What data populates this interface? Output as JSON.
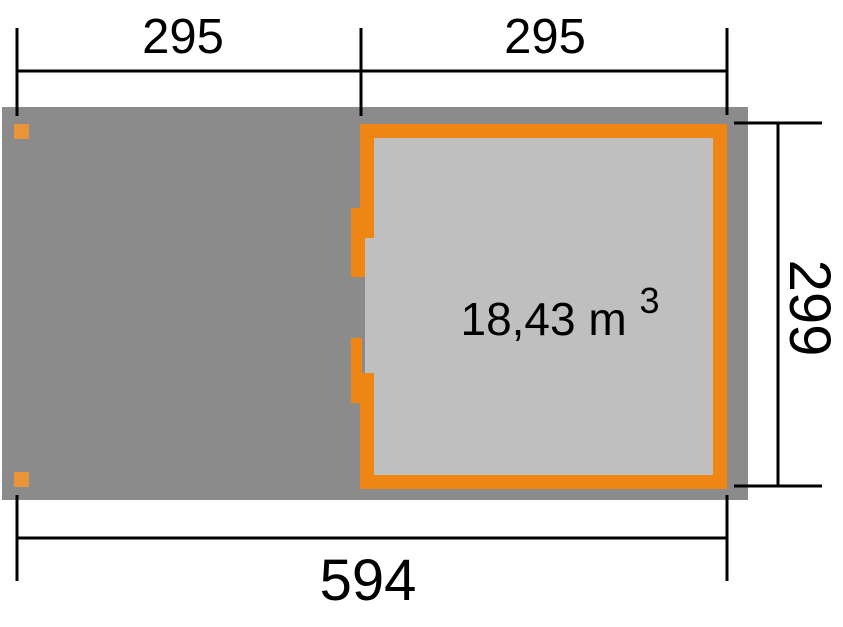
{
  "plan": {
    "volume": {
      "value": "18,43 m",
      "exponent": "3"
    },
    "dimensions": {
      "top_left": "295",
      "top_right": "295",
      "right": "299",
      "bottom": "594"
    },
    "colors": {
      "floor_dark_gray": "#8B8B8B",
      "interior_light_gray": "#BFBFBF",
      "wall_orange": "#EF8512",
      "post_orange": "#EA9439",
      "dimension_black": "#000000"
    }
  }
}
